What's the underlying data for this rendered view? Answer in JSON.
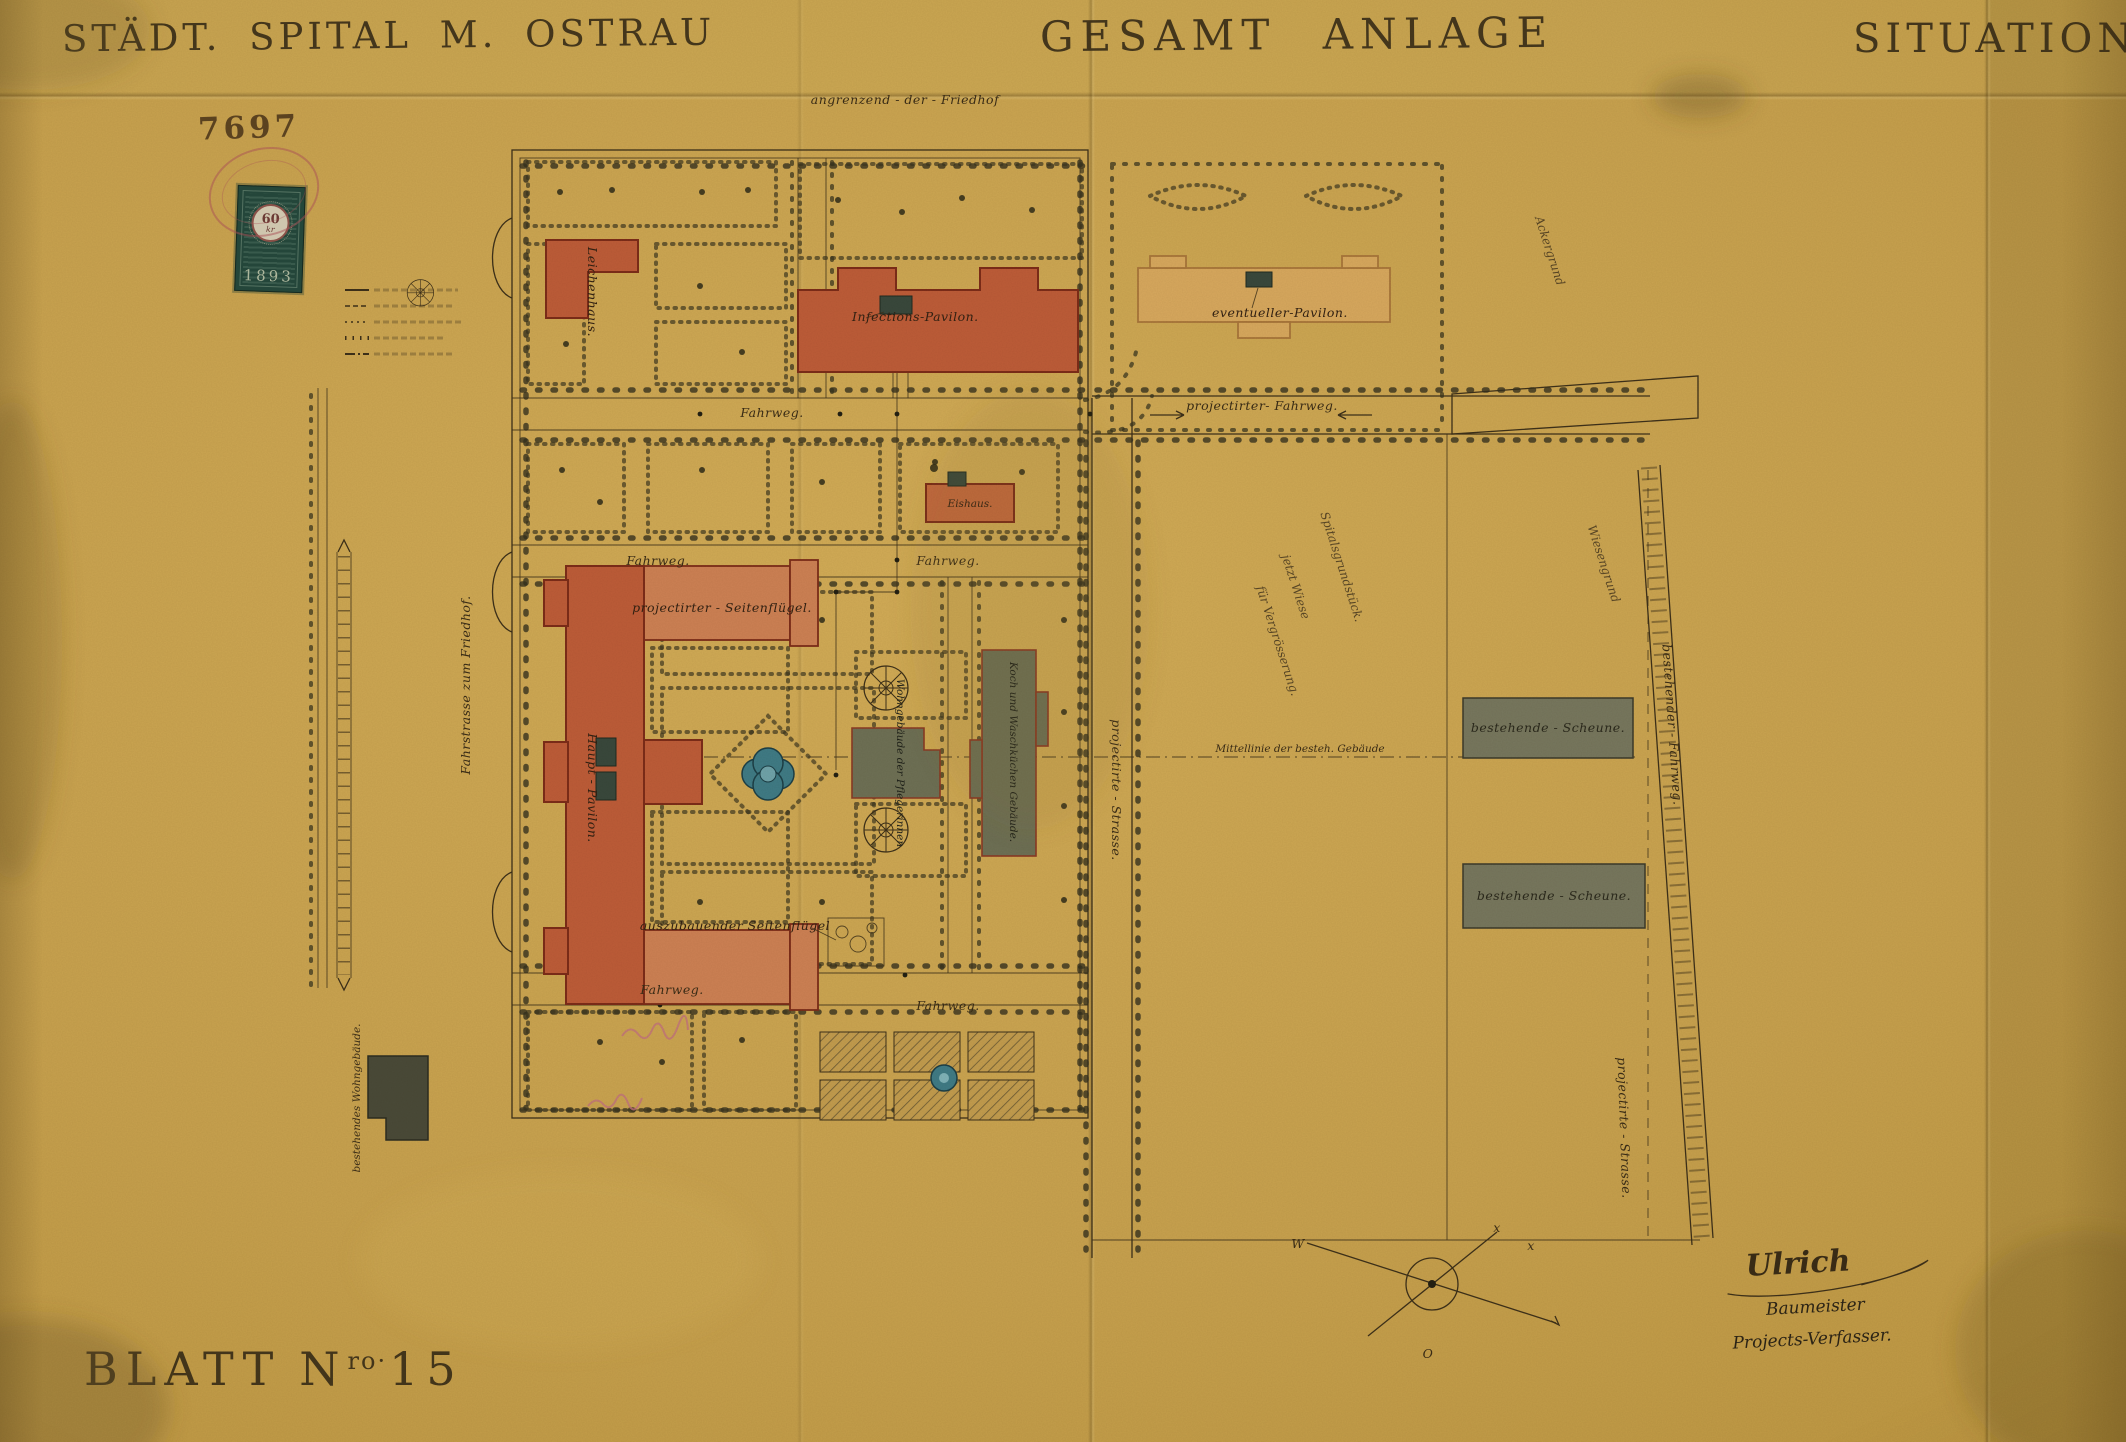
{
  "titles": {
    "left": "STÄDT. SPITAL M. OSTRAU",
    "center": "GESAMT ANLAGE",
    "right": "SITUATION"
  },
  "header": {
    "plan_number": "7697",
    "edge_note": "angrenzend - der - Friedhof"
  },
  "stamp": {
    "value": "60",
    "unit": "kr",
    "year": "1893"
  },
  "sheet": {
    "word": "BLATT",
    "n": "N",
    "sup": "ro·",
    "num": "15"
  },
  "signature": {
    "name": "Ulrich",
    "role1": "Baumeister",
    "role2": "Projects-Verfasser."
  },
  "compass": {
    "w": "W",
    "o": "O",
    "x1": "x",
    "x2": "x"
  },
  "buildings": {
    "leichenhaus": "Leichenhaus.",
    "infections_pavilon": "Infections-Pavilon.",
    "eventueller_pavilon": "eventueller-Pavilon.",
    "eishaus": "Eishaus.",
    "haupt_pavilon": "Haupt - Pavilon.",
    "proj_seitenfluegel": "projectirter - Seitenflügel.",
    "auszub_seitenfluegel": "auszubauender Seitenflügel",
    "wohngebaeude_pflegerinnen": "Wohngebäude der Pflegerinnen",
    "kochkueche": "Koch und Waschküchen Gebäude.",
    "scheune": "bestehende - Scheune.",
    "wohngebaeude_best": "bestehendes Wohngebäude."
  },
  "roads": {
    "fahrweg": "Fahrweg.",
    "proj_fahrweg": "projectirter- Fahrweg.",
    "proj_strasse": "projectirte - Strasse.",
    "best_fahrweg": "bestehender - Fahrweg.",
    "fahrstrasse_friedhof": "Fahrstrasse zum Friedhof.",
    "mittellinie": "Mittellinie der besteh. Gebäude"
  },
  "areas": {
    "spitalsgrund": "Spitalsgrundstück.",
    "jetzt_wiese": "jetzt Wiese",
    "vergroesserung": "für Vergrösserung.",
    "wiesengrund": "Wiesengrund",
    "ackergrund": "Ackergrund"
  },
  "colors": {
    "paper": "#c7a14e",
    "ink": "#3d3019",
    "building_red": "#bd5c38",
    "building_tan": "#d7a85e",
    "building_gray": "#6e7055",
    "water": "#3f7b86",
    "stamp_green": "#24463a",
    "postmark_red": "#aa5055"
  }
}
